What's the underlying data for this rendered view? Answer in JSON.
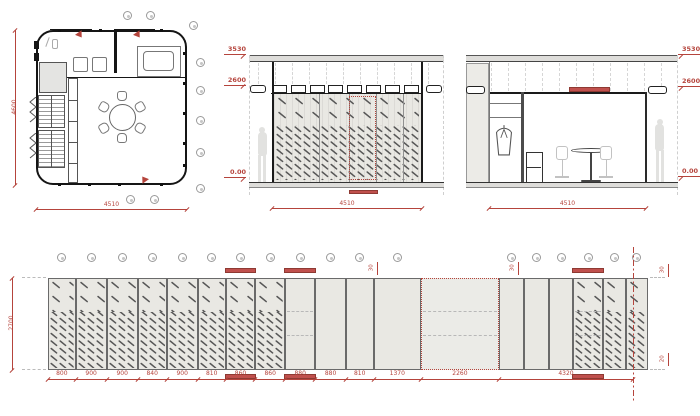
{
  "meta": {
    "accent": "#b5443c",
    "bar_fill": "#c0504d",
    "bar_edge": "#8e3a33",
    "panel_fill": "#e9e8e3",
    "hatch_color": "#575757"
  },
  "plan": {
    "dim_width": "4510",
    "dim_height": "4600"
  },
  "front_elevation": {
    "levels": [
      "3530",
      "2600",
      "0.00"
    ],
    "dim_width": "4510"
  },
  "interior_elevation": {
    "levels": [
      "3530",
      "2600",
      "0.00"
    ],
    "dim_width": "4510"
  },
  "glazing_elevation": {
    "dim_height": "2700",
    "group_dim": "4320",
    "offset_dims": [
      {
        "label": "30",
        "pos": "top-a"
      },
      {
        "label": "30",
        "pos": "top-b"
      },
      {
        "label": "30",
        "pos": "right-top"
      },
      {
        "label": "20",
        "pos": "right-bottom"
      }
    ],
    "panels": [
      {
        "w": 800,
        "label": "800",
        "hatch": true
      },
      {
        "w": 900,
        "label": "900",
        "hatch": true
      },
      {
        "w": 900,
        "label": "900",
        "hatch": true
      },
      {
        "w": 840,
        "label": "840",
        "hatch": true
      },
      {
        "w": 900,
        "label": "900",
        "hatch": true
      },
      {
        "w": 810,
        "label": "810",
        "hatch": true
      },
      {
        "w": 860,
        "label": "860",
        "hatch": true,
        "bars": true
      },
      {
        "w": 860,
        "label": "860",
        "hatch": true
      },
      {
        "w": 880,
        "label": "880",
        "bars": true,
        "rails": true
      },
      {
        "w": 880,
        "label": "880"
      },
      {
        "w": 810,
        "label": "810"
      },
      {
        "w": 1370,
        "label": "1370"
      },
      {
        "w": 2260,
        "label": "2260",
        "dotted": true,
        "rails": true
      },
      {
        "w": 720,
        "group": true
      },
      {
        "w": 720,
        "group": true
      },
      {
        "w": 720,
        "group": true
      },
      {
        "w": 870,
        "group": true,
        "hatch": true,
        "bars": true,
        "rails": true
      },
      {
        "w": 645,
        "group": true,
        "hatch": true
      },
      {
        "w": 645,
        "group": true,
        "hatch": true
      }
    ]
  }
}
